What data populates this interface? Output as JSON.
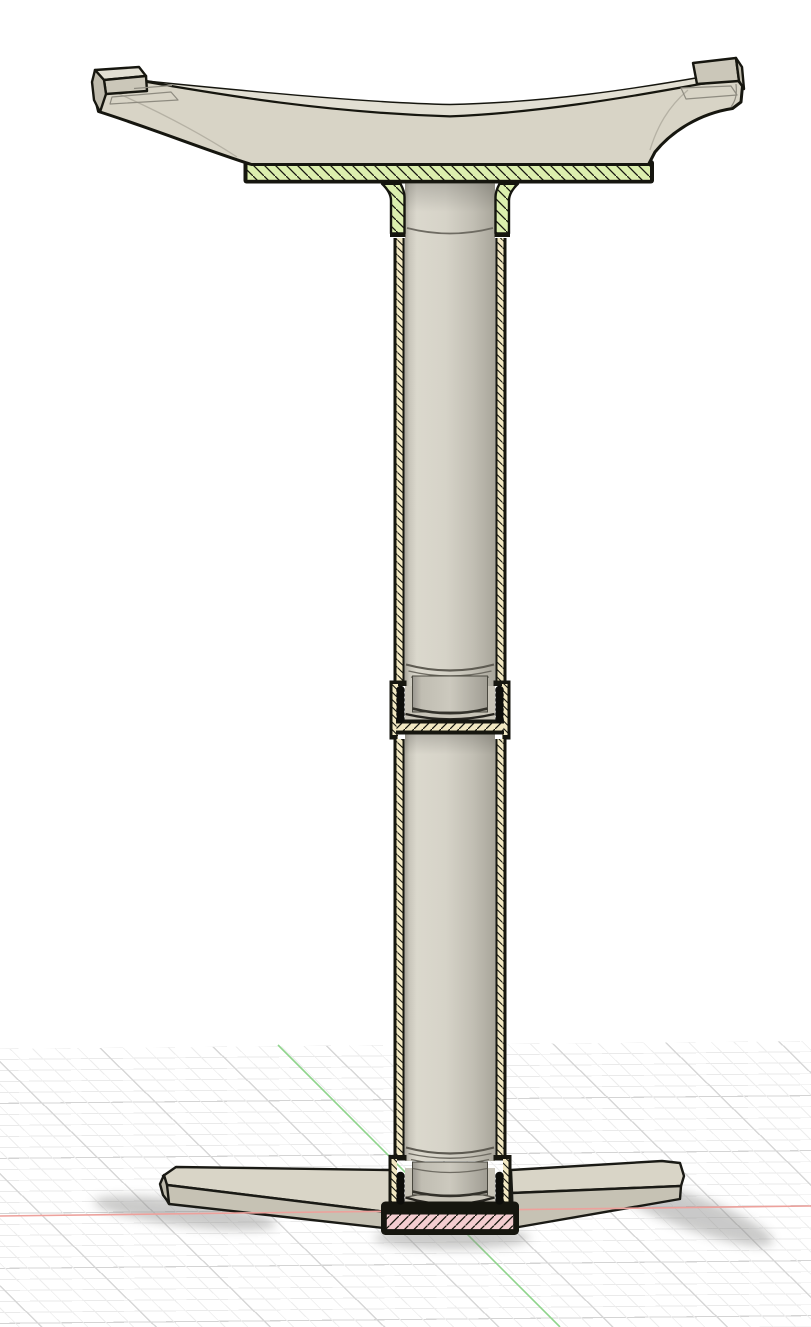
{
  "scene": {
    "background": "#ffffff"
  },
  "grid": {
    "minor": "#eaeaea",
    "major": "#d4d4d4",
    "diag_minor": "#ededed",
    "diag_major": "#d7d7d7"
  },
  "axes": {
    "x": "#eda19c",
    "y": "#8fd48c"
  },
  "sections": {
    "top_plate_fill": "#dcefae",
    "tube_wall_fill": "#f2e8c2",
    "base_plate_fill": "#f4cdd0",
    "hatch_line": "#17170f"
  },
  "materials": {
    "body": "#d8d4c6",
    "body_top": "#e2dfd3",
    "body_front": "#cbc7b9",
    "body_side": "#bfbbad",
    "leg_top": "#d9d5c7",
    "leg_front": "#c6c2b4",
    "bore_fill": "#c8c4b8",
    "outline": "#16160f",
    "thread": "#0d0d0a",
    "shadow": "#8a8a88"
  }
}
